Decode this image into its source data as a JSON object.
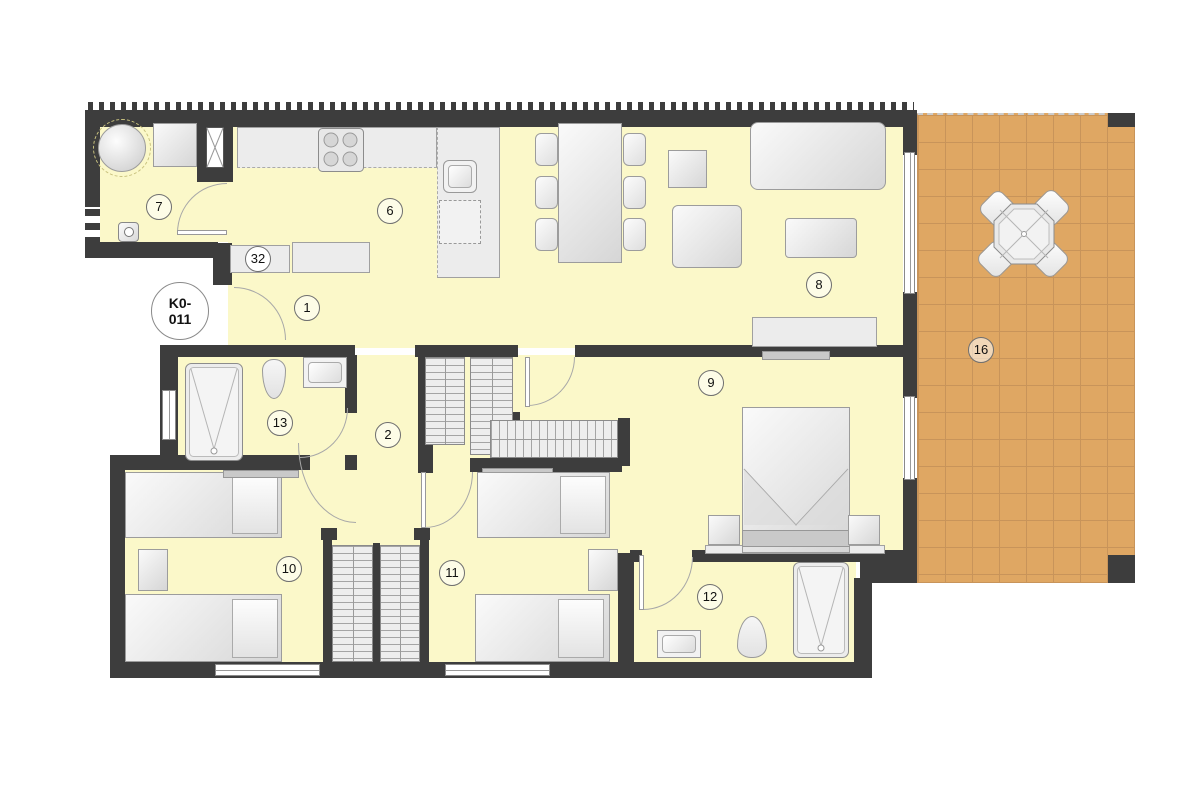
{
  "plan": {
    "unit_id": {
      "line1": "K0-",
      "line2": "011"
    },
    "colors": {
      "wall": "#3d3d3d",
      "floor": "#fbf8c9",
      "terrace": "#dfa763",
      "terrace_grid": "#c8945a",
      "furniture": "#e9e9e9"
    },
    "labels": [
      {
        "id": "hall-entry",
        "number": "1"
      },
      {
        "id": "hall-inner",
        "number": "2"
      },
      {
        "id": "kitchen",
        "number": "6"
      },
      {
        "id": "utility",
        "number": "7"
      },
      {
        "id": "living-room",
        "number": "8"
      },
      {
        "id": "bedroom-master",
        "number": "9"
      },
      {
        "id": "bedroom-left",
        "number": "10"
      },
      {
        "id": "bedroom-middle",
        "number": "11"
      },
      {
        "id": "bathroom-ensuite",
        "number": "12"
      },
      {
        "id": "bathroom-main",
        "number": "13"
      },
      {
        "id": "terrace",
        "number": "16"
      },
      {
        "id": "cabinet-element",
        "number": "32"
      }
    ]
  }
}
